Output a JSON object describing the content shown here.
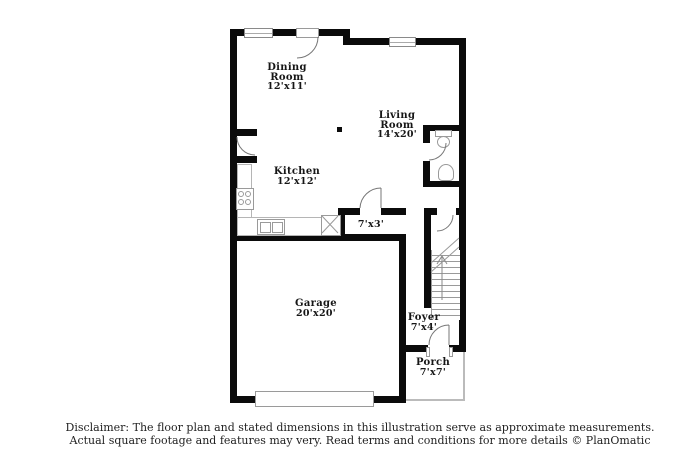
{
  "plan": {
    "rooms": {
      "dining": {
        "name": "Dining Room",
        "dims": "12'x11'"
      },
      "living": {
        "name": "Living Room",
        "dims": "14'x20'"
      },
      "kitchen": {
        "name": "Kitchen",
        "dims": "12'x12'"
      },
      "utility": {
        "dims": "7'x3'"
      },
      "garage": {
        "name": "Garage",
        "dims": "20'x20'"
      },
      "foyer": {
        "name": "Foyer",
        "dims": "7'x4'"
      },
      "porch": {
        "name": "Porch",
        "dims": "7'x7'"
      }
    },
    "colors": {
      "wall": "#0b0b0b",
      "fixture_line": "#9a9a9a",
      "porch_line": "#bbbbbb"
    }
  },
  "footer": {
    "line1": "Disclaimer: The floor plan and stated dimensions in this illustration serve as approximate measurements.",
    "line2": "Actual square footage and features may very. Read terms and conditions for more details © PlanOmatic"
  }
}
